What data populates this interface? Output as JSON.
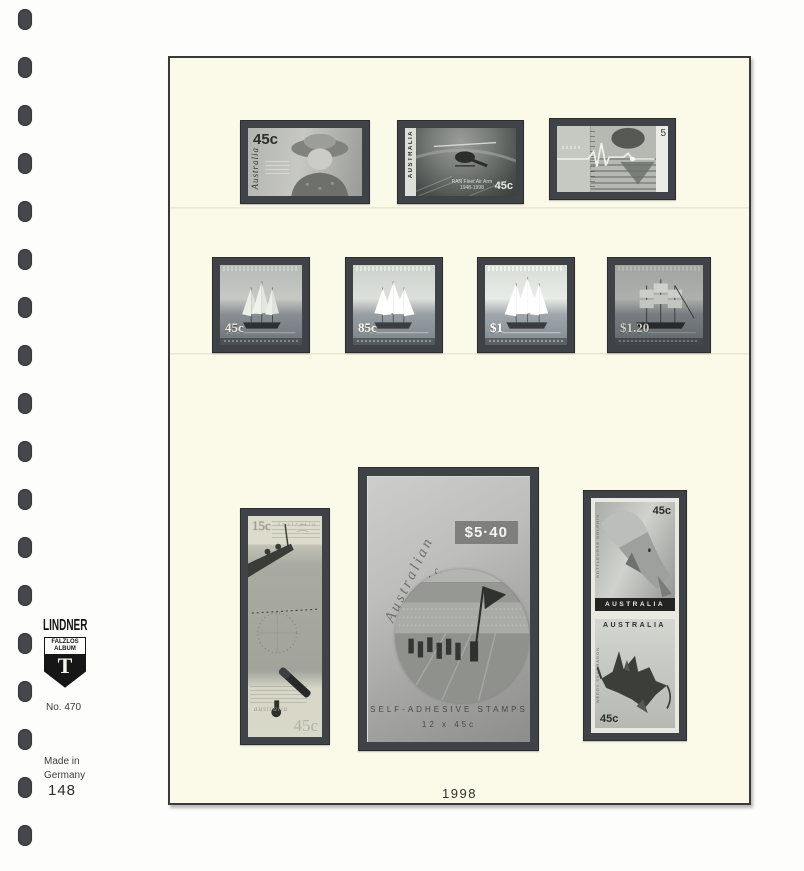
{
  "binder": {
    "hole_count": 18
  },
  "sidebar": {
    "brand": "LINDNER",
    "badge": {
      "line1": "FALZLOS",
      "line2": "ALBUM",
      "letter": "T"
    },
    "ref_no": "No. 470",
    "origin_line1": "Made in",
    "origin_line2": "Germany",
    "page_number": "148"
  },
  "page": {
    "year_label": "1998",
    "colors": {
      "page_bg": "#FBFAE9",
      "mount": "#3F4247",
      "backing_white": "#E9E9E1"
    }
  },
  "row1": {
    "queen_stamp": {
      "value": "45c",
      "country": "Australia"
    },
    "helicopter_stamp": {
      "country": "AUSTRALIA",
      "caption": "RAN Fleet Air Arm",
      "years": "1948-1998",
      "value": "45c"
    },
    "heart_stamp": {
      "value_digit": "5"
    }
  },
  "row2": {
    "values": [
      "45c",
      "85c",
      "$1",
      "$1.20"
    ]
  },
  "bottom": {
    "explorer_stamp": {
      "top_value": "15c",
      "top_country": "Australia",
      "bottom_country": "australia",
      "bottom_value": "45c"
    },
    "booklet": {
      "script_line1": "Australian",
      "script_line2": "Olympic",
      "script_line3": "Legends",
      "price": "$5·40",
      "footer_line1": "SELF-ADHESIVE STAMPS",
      "footer_line2": "12 x 45c"
    },
    "ocean_pair": {
      "top": {
        "value": "45c",
        "country": "AUSTRALIA",
        "species": "BOTTLENOSE DOLPHIN"
      },
      "bottom": {
        "country": "AUSTRALIA",
        "value": "45c",
        "species": "WEEDY SEADRAGON"
      }
    }
  }
}
